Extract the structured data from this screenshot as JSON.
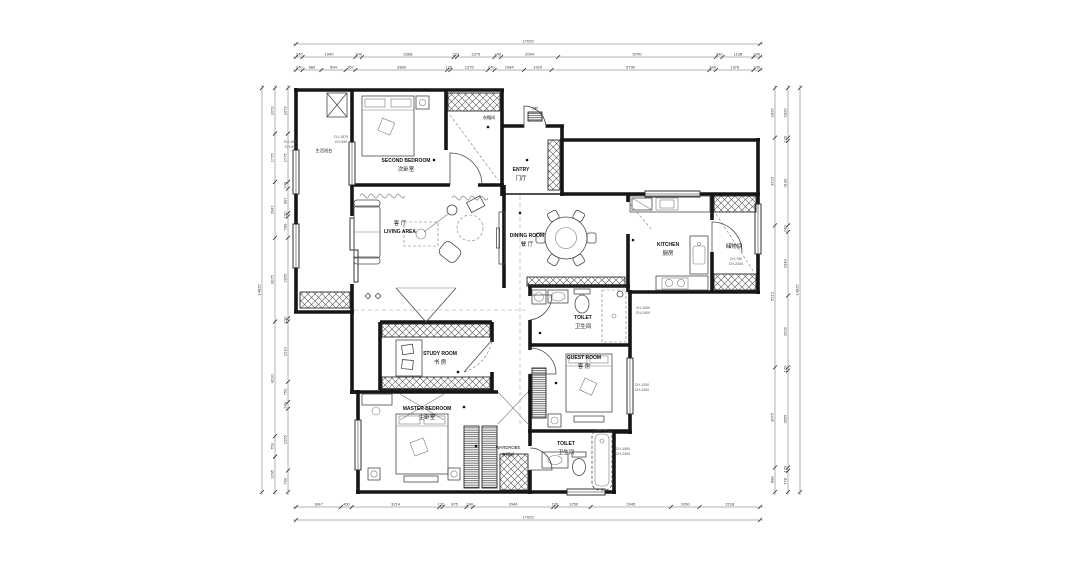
{
  "plan": {
    "rooms": {
      "balcony": {
        "zh": "生活阳台"
      },
      "second_bedroom": {
        "en": "SECOND BEDROOM",
        "zh": "次卧室"
      },
      "closet": {
        "zh": "衣帽间"
      },
      "entry": {
        "en": "ENTRY",
        "zh": "门厅"
      },
      "ap": "AP",
      "living": {
        "en": "LIVING AREA",
        "zh": "客 厅"
      },
      "dining": {
        "en": "DINING ROOM",
        "zh": "餐 厅"
      },
      "kitchen": {
        "en": "KITCHEN",
        "zh": "厨房"
      },
      "storage": {
        "zh": "储物间"
      },
      "toilet_upper": {
        "en": "TOILET",
        "zh": "卫生间"
      },
      "study": {
        "en": "STUDY ROOM",
        "zh": "书 房"
      },
      "guest": {
        "en": "GUEST ROOM",
        "zh": "客 房"
      },
      "master": {
        "en": "MASTER BEDROOM",
        "zh": "主卧室"
      },
      "wardrobe": {
        "en": "WARDROBE",
        "zh": "衣帽间"
      },
      "toilet_lower": {
        "en": "TOILET",
        "zh": "卫生间"
      }
    },
    "notes": {
      "balcony_win_a": [
        "CU-1875",
        "CH-990"
      ],
      "balcony_win_b": [
        "CU-1875",
        "CH-990"
      ],
      "guest_win": [
        "CH-1500",
        "CH-2400"
      ],
      "toilet_win": [
        "CH-1200",
        "CH-2400"
      ],
      "storage_win": [
        "CH-780",
        "CH-2340"
      ],
      "bath_win": [
        "CH-1500",
        "CH-2400"
      ]
    },
    "dims": {
      "top_total": [
        17025
      ],
      "top_row1": [
        240,
        1940,
        240,
        3368,
        120,
        1375,
        240,
        2094,
        5790,
        240,
        1138,
        240
      ],
      "top_row2": [
        240,
        689,
        894,
        357,
        3368,
        120,
        1375,
        240,
        1084,
        1010,
        5790,
        240,
        1378,
        240
      ],
      "bottom_row1": [
        1647,
        400,
        3214,
        120,
        875,
        240,
        2946,
        120,
        1250,
        2945,
        1050,
        2218
      ],
      "bottom_total": [
        17025
      ],
      "left_total": [
        14825
      ],
      "left_col1": [
        1673,
        1775,
        2047,
        3075,
        4210,
        750,
        1295
      ],
      "left_col2": [
        1673,
        1775,
        240,
        907,
        120,
        780,
        2955,
        120,
        2210,
        750,
        240,
        2265,
        790
      ],
      "right_col1": [
        1820,
        3220,
        5212,
        3675,
        898
      ],
      "right_col2": [
        1820,
        120,
        3100,
        240,
        2340,
        2632,
        120,
        3555,
        120,
        778
      ],
      "right_total": [
        14825
      ]
    }
  }
}
